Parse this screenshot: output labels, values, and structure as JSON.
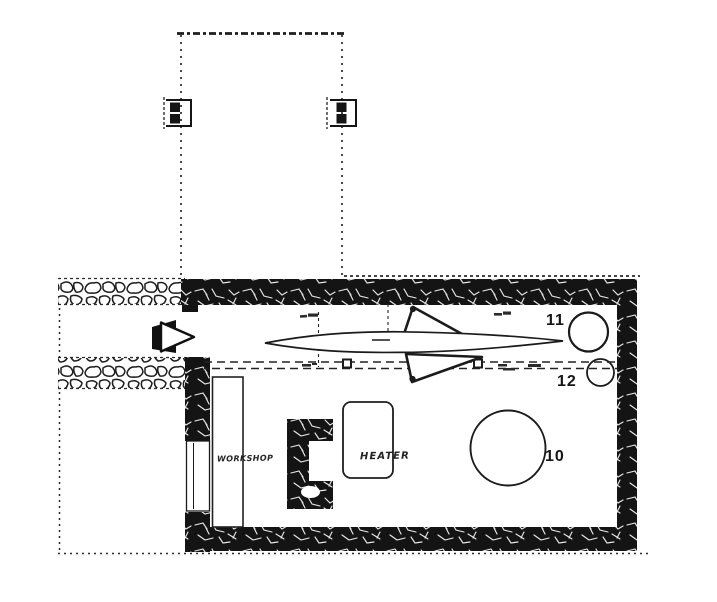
{
  "drawing": {
    "kind": "scanned architectural floor plan",
    "room_labels": {
      "workshop": "WORKSHOP",
      "heater": "HEATER"
    },
    "number_markers": {
      "m10": "10",
      "m11": "11",
      "m12": "12"
    },
    "icons": {
      "entrance_arrow": "right-pointing-triangle",
      "aircraft": "swept-wing-aircraft-plan-silhouette",
      "gate_posts": "bracket-with-two-filled-squares"
    },
    "colors": {
      "ink": "#1b1b1b",
      "wall_fill": "#141414",
      "paper": "#ffffff"
    }
  }
}
